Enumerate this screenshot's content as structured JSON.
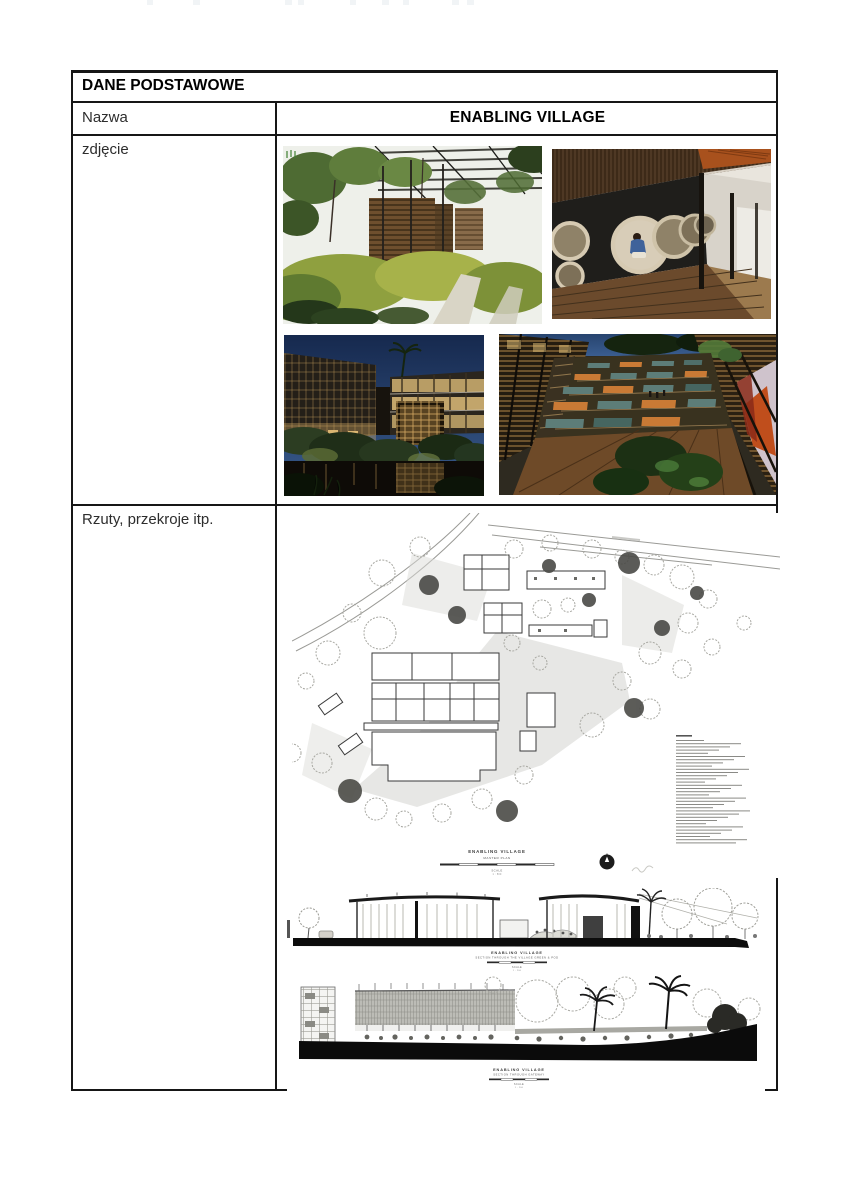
{
  "document": {
    "header": "DANE PODSTAWOWE",
    "name_label": "Nazwa",
    "name_value": "ENABLING VILLAGE",
    "photo_label": "zdjęcie",
    "drawings_label": "Rzuty, przekroje itp."
  },
  "photos": [
    {
      "name": "garden-pavilion",
      "description": "Lush tropical garden with timber pallet pavilion under a dark louvred canopy"
    },
    {
      "name": "pipe-wall-walkway",
      "description": "Timber boardwalk beside a dark wall with round concrete pipe niches, slatted timber band above, person seated inside a pipe"
    },
    {
      "name": "pond-courtyard-night",
      "description": "Courtyard buildings with glowing gridded facades around a wetland pond at dusk"
    },
    {
      "name": "terraced-amphitheatre-night",
      "description": "Terraced courtyard amphitheatre with orange and teal benches glowing at dusk"
    }
  ],
  "drawings": {
    "master_plan": {
      "title": "ENABLING VILLAGE",
      "subtitle": "MASTER PLAN",
      "scale_label": "SCALE",
      "scale_note": "1 : 500"
    },
    "section_1": {
      "title": "ENABLING VILLAGE",
      "subtitle": "SECTION THROUGH THE VILLAGE GREEN & POD",
      "scale_label": "SCALE",
      "scale_note": "1 : 200"
    },
    "section_2": {
      "title": "ENABLING VILLAGE",
      "subtitle": "SECTION THROUGH GATEWAY",
      "scale_label": "SCALE",
      "scale_note": "1 : 200"
    }
  }
}
